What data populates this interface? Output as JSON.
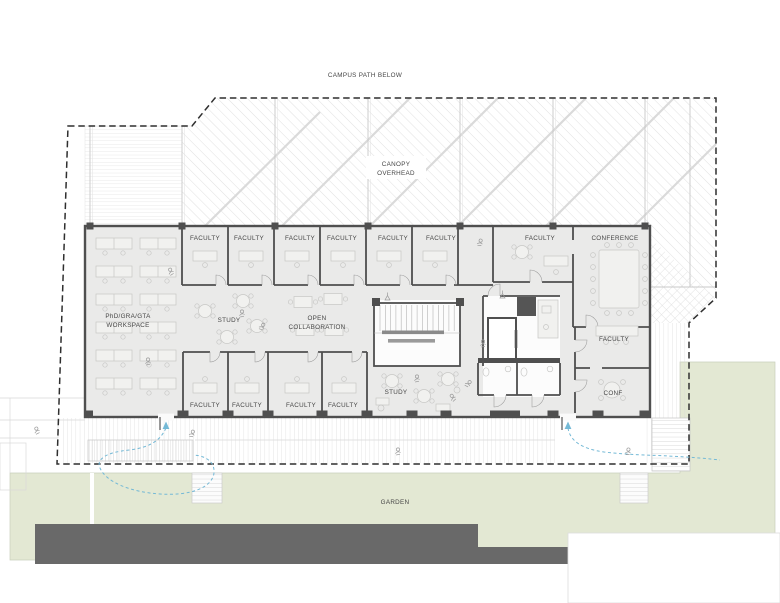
{
  "drawing": {
    "type": "architectural-floor-plan",
    "level": "upper floor of academic building"
  },
  "colors": {
    "floor": "#eaeae9",
    "wall": "#4f4f4f",
    "garden": "#e3e8d3",
    "band": "#696969",
    "blue": "#74b9d6",
    "boundary": "#2f2f2f"
  },
  "labels": [
    {
      "name": "label-campus-path",
      "text": "CAMPUS PATH BELOW",
      "x": 365,
      "y": 77,
      "fs": 6.4,
      "ls": 0.7
    },
    {
      "name": "label-canopy-line1",
      "text": "CANOPY",
      "x": 396,
      "y": 166
    },
    {
      "name": "label-canopy-line2",
      "text": "OVERHEAD",
      "x": 396,
      "y": 175
    },
    {
      "name": "label-faculty-top-1",
      "text": "FACULTY",
      "x": 205,
      "y": 240
    },
    {
      "name": "label-faculty-top-2",
      "text": "FACULTY",
      "x": 249,
      "y": 240
    },
    {
      "name": "label-faculty-top-3",
      "text": "FACULTY",
      "x": 300,
      "y": 240
    },
    {
      "name": "label-faculty-top-4",
      "text": "FACULTY",
      "x": 342,
      "y": 240
    },
    {
      "name": "label-faculty-top-5",
      "text": "FACULTY",
      "x": 393,
      "y": 240
    },
    {
      "name": "label-faculty-top-6",
      "text": "FACULTY",
      "x": 441,
      "y": 240
    },
    {
      "name": "label-faculty-top-7",
      "text": "FACULTY",
      "x": 540,
      "y": 240
    },
    {
      "name": "label-conference",
      "text": "CONFERENCE",
      "x": 615,
      "y": 240
    },
    {
      "name": "label-phd-line1",
      "text": "PhD/GRA/GTA",
      "x": 128,
      "y": 318
    },
    {
      "name": "label-phd-line2",
      "text": "WORKSPACE",
      "x": 128,
      "y": 327
    },
    {
      "name": "label-study-1",
      "text": "STUDY",
      "x": 229,
      "y": 322
    },
    {
      "name": "label-open-line1",
      "text": "OPEN",
      "x": 317,
      "y": 320
    },
    {
      "name": "label-open-line2",
      "text": "COLLABORATION",
      "x": 317,
      "y": 329
    },
    {
      "name": "label-study-2",
      "text": "STUDY",
      "x": 396,
      "y": 394
    },
    {
      "name": "label-faculty-bot-1",
      "text": "FACULTY",
      "x": 205,
      "y": 407
    },
    {
      "name": "label-faculty-bot-2",
      "text": "FACULTY",
      "x": 247,
      "y": 407
    },
    {
      "name": "label-faculty-bot-3",
      "text": "FACULTY",
      "x": 301,
      "y": 407
    },
    {
      "name": "label-faculty-bot-4",
      "text": "FACULTY",
      "x": 343,
      "y": 407
    },
    {
      "name": "label-faculty-right",
      "text": "FACULTY",
      "x": 614,
      "y": 341
    },
    {
      "name": "label-conf-right",
      "text": "CONF",
      "x": 613,
      "y": 395
    },
    {
      "name": "label-garden",
      "text": "GARDEN",
      "x": 395,
      "y": 504
    }
  ]
}
